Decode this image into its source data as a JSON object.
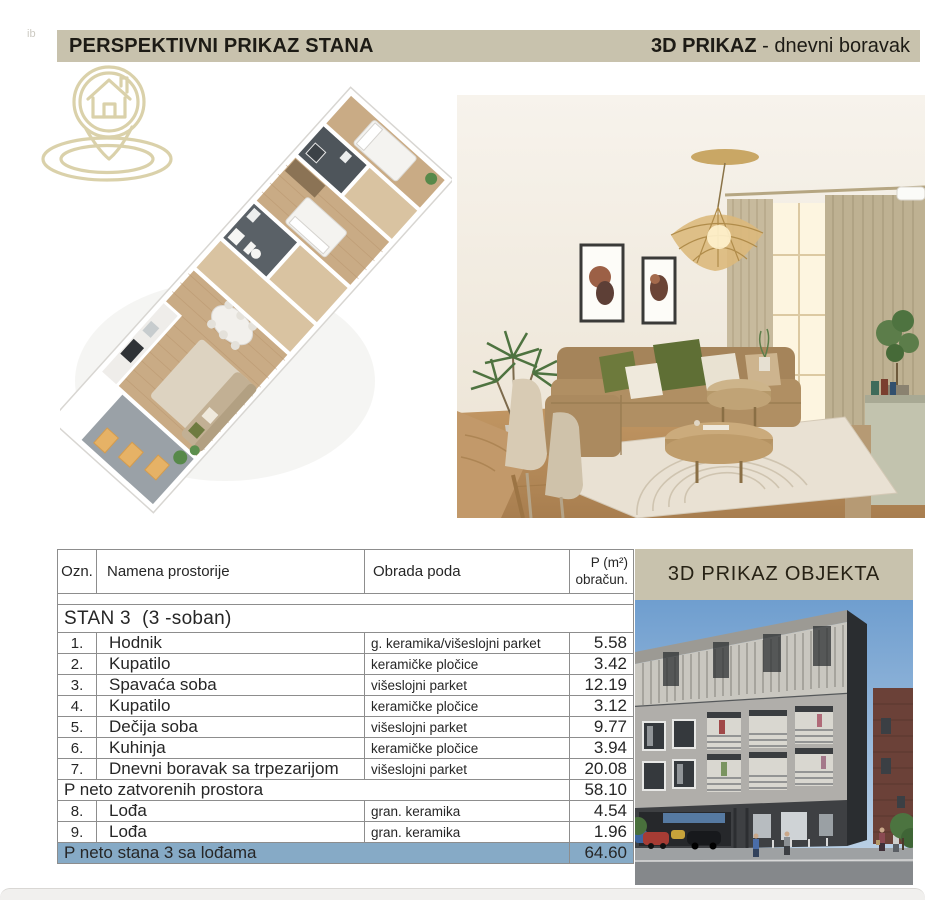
{
  "meta": {
    "corner_mark": "ib"
  },
  "colors": {
    "band_bg": "#c8c2ad",
    "total_row_bg": "#86aac6",
    "logo_stroke": "#d9cfa6"
  },
  "top_header": {
    "left_title": "PERSPEKTIVNI PRIKAZ STANA",
    "right_bold": "3D PRIKAZ",
    "right_rest": " - dnevni boravak"
  },
  "object_panel": {
    "title": "3D PRIKAZ OBJEKTA"
  },
  "table": {
    "header": {
      "ozn": "Ozn.",
      "name": "Namena prostorije",
      "floor": "Obrada poda",
      "p_line1": "P (m²)",
      "p_line2": "obračun."
    },
    "group_title": "STAN 3  (3 -soban)",
    "rows": [
      {
        "ozn": "1.",
        "name": "Hodnik",
        "floor": "g. keramika/višeslojni parket",
        "area": "5.58"
      },
      {
        "ozn": "2.",
        "name": "Kupatilo",
        "floor": "keramičke pločice",
        "area": "3.42"
      },
      {
        "ozn": "3.",
        "name": "Spavaća soba",
        "floor": "višeslojni parket",
        "area": "12.19"
      },
      {
        "ozn": "4.",
        "name": "Kupatilo",
        "floor": "keramičke pločice",
        "area": "3.12"
      },
      {
        "ozn": "5.",
        "name": "Dečija soba",
        "floor": "višeslojni parket",
        "area": "9.77"
      },
      {
        "ozn": "6.",
        "name": "Kuhinja",
        "floor": "keramičke pločice",
        "area": "3.94"
      },
      {
        "ozn": "7.",
        "name": "Dnevni boravak sa trpezarijom",
        "floor": "višeslojni parket",
        "area": "20.08"
      }
    ],
    "subtotal": {
      "label": "P neto zatvorenih prostora",
      "area": "58.10"
    },
    "lodge_rows": [
      {
        "ozn": "8.",
        "name": "Lođa",
        "floor": "gran. keramika",
        "area": "4.54"
      },
      {
        "ozn": "9.",
        "name": "Lođa",
        "floor": "gran. keramika",
        "area": "1.96"
      }
    ],
    "total": {
      "label": "P neto stana 3 sa lođama",
      "area": "64.60"
    }
  }
}
